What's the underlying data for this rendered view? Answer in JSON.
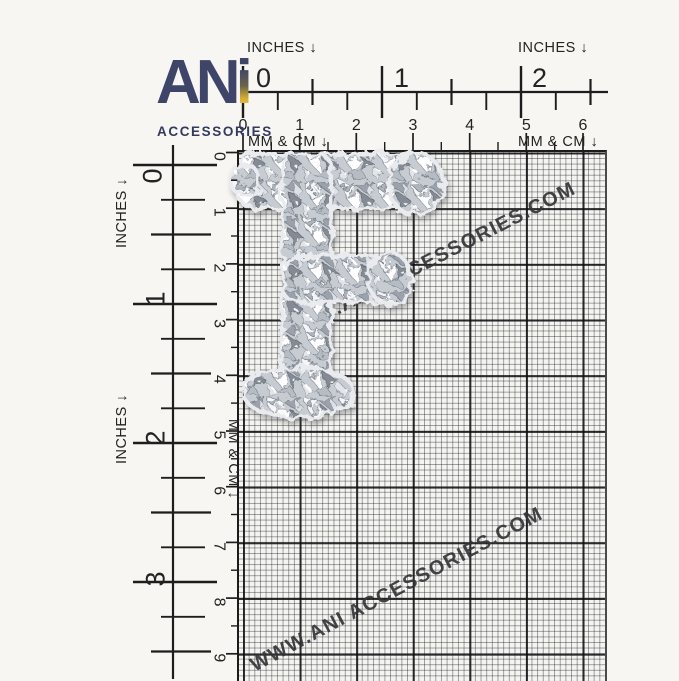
{
  "page": {
    "background": "#f7f6f3"
  },
  "logo": {
    "an": "AN",
    "i": "i",
    "subtitle": "ACCESSORIES",
    "navy": "#3f4469",
    "gold": "#e8c53a"
  },
  "rulers": {
    "top": {
      "inches_label_left": "INCHES ↓",
      "inches_label_right": "INCHES ↓",
      "inch_numbers": [
        "0",
        "1",
        "2"
      ],
      "cm_numbers": [
        "0",
        "1",
        "2",
        "3",
        "4",
        "5",
        "6"
      ],
      "mmcm_label_left": "MM & CM ↓",
      "mmcm_label_right": "MM & CM ↓"
    },
    "left": {
      "inches_label_upper": "INCHES ↓",
      "inches_label_lower": "INCHES ↓",
      "inch_numbers": [
        "0",
        "1",
        "2",
        "3"
      ],
      "cm_numbers": [
        "0",
        "1",
        "2",
        "3",
        "4",
        "5",
        "6",
        "7",
        "8",
        "9"
      ],
      "mmcm_label": "MM & CM ↓"
    }
  },
  "watermark": {
    "upper": "WWW.ANI ACCESSORIES.COM",
    "lower": "WWW.ANI ACCESSORIES.COM",
    "color": "#343438"
  },
  "product": {
    "letter": "F"
  },
  "grid": {
    "mm_line": "#1e1e24",
    "cm_line": "#0c0c0f",
    "background": "#f4f4f1"
  }
}
